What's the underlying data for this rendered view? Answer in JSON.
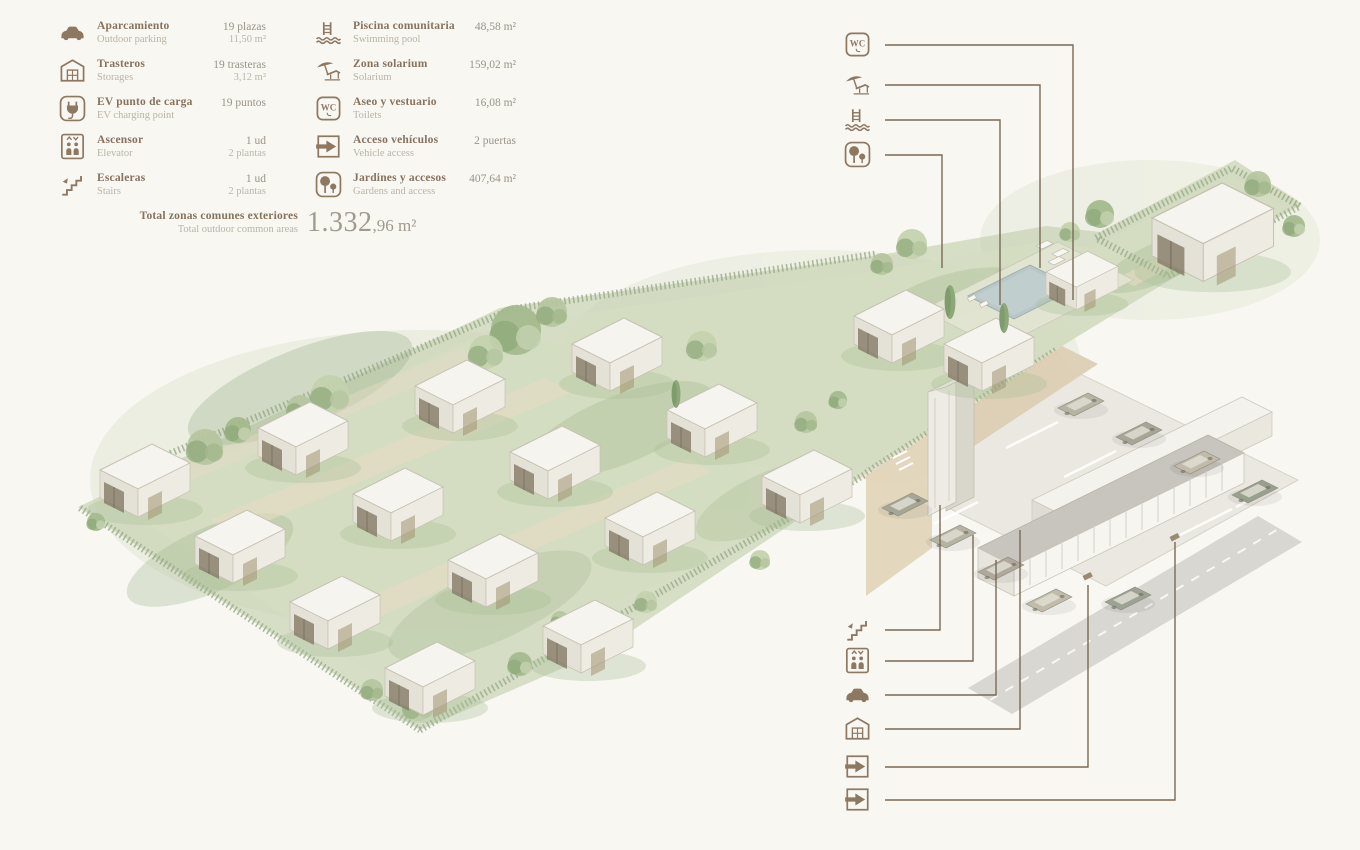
{
  "colors": {
    "accent_brown": "#8d7862",
    "line_brown": "#7a6955",
    "sage": "#b9c8a2",
    "paper": "#f8f7f2",
    "pool_water": "#bac7c8",
    "wall_tan": "#e2d5bb"
  },
  "legend": {
    "col1": [
      {
        "sym": "#sym-car",
        "es": "Aparcamiento",
        "en": "Outdoor parking",
        "v1": "19 plazas",
        "v2": "11,50 m²"
      },
      {
        "sym": "#sym-storage",
        "es": "Trasteros",
        "en": "Storages",
        "v1": "19 trasteras",
        "v2": "3,12 m²"
      },
      {
        "sym": "#sym-ev",
        "es": "EV punto de carga",
        "en": "EV charging point",
        "v1": "19 puntos",
        "v2": ""
      },
      {
        "sym": "#sym-elevator",
        "es": "Ascensor",
        "en": "Elevator",
        "v1": "1 ud",
        "v2": "2 plantas"
      },
      {
        "sym": "#sym-stairs",
        "es": "Escaleras",
        "en": "Stairs",
        "v1": "1 ud",
        "v2": "2 plantas"
      }
    ],
    "col2": [
      {
        "sym": "#sym-pool",
        "es": "Piscina comunitaria",
        "en": "Swimming pool",
        "v1": "48,58 m²",
        "v2": ""
      },
      {
        "sym": "#sym-solarium",
        "es": "Zona solarium",
        "en": "Solarium",
        "v1": "159,02 m²",
        "v2": ""
      },
      {
        "sym": "#sym-wc",
        "es": "Aseo y vestuario",
        "en": "Toilets",
        "v1": "16,08 m²",
        "v2": ""
      },
      {
        "sym": "#sym-access",
        "es": "Acceso vehículos",
        "en": "Vehicle access",
        "v1": "2 puertas",
        "v2": ""
      },
      {
        "sym": "#sym-gardens",
        "es": "Jardines y accesos",
        "en": "Gardens and access",
        "v1": "407,64 m²",
        "v2": ""
      }
    ],
    "total": {
      "es": "Total zonas comunes exteriores",
      "en": "Total outdoor common areas",
      "value_big": "1.332",
      "value_small": ",96 m²"
    }
  },
  "callouts": {
    "top": [
      {
        "name": "wc",
        "sym": "#sym-wc"
      },
      {
        "name": "solarium",
        "sym": "#sym-solarium"
      },
      {
        "name": "pool",
        "sym": "#sym-pool"
      },
      {
        "name": "gardens",
        "sym": "#sym-gardens"
      }
    ],
    "bottom": [
      {
        "name": "stairs",
        "sym": "#sym-stairs"
      },
      {
        "name": "elevator",
        "sym": "#sym-elevator"
      },
      {
        "name": "car",
        "sym": "#sym-car"
      },
      {
        "name": "storage",
        "sym": "#sym-storage"
      },
      {
        "name": "vehicle-access-1",
        "sym": "#sym-access"
      },
      {
        "name": "vehicle-access-2",
        "sym": "#sym-access"
      }
    ]
  }
}
